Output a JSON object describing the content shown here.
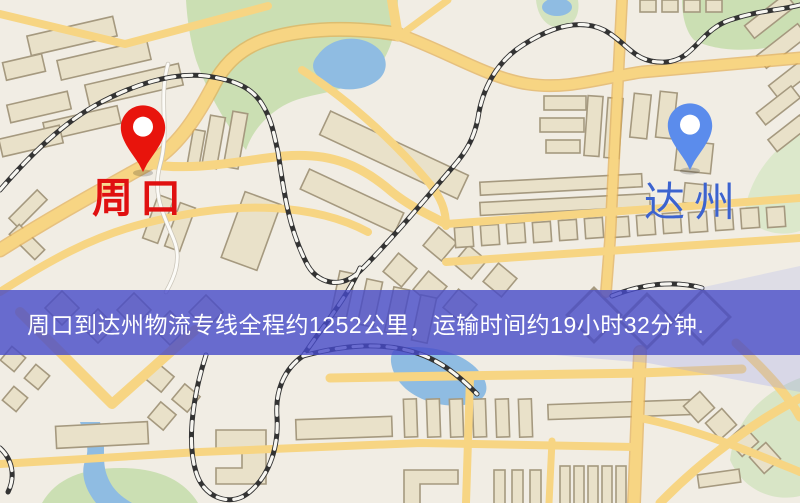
{
  "map": {
    "markers": {
      "origin": {
        "label": "周口",
        "pin_color": "#e8140c",
        "label_color": "#e01010",
        "pin_icon": "map-pin"
      },
      "destination": {
        "label": "达州",
        "pin_color": "#5b8cec",
        "label_color": "#3c63cf",
        "pin_icon": "map-pin"
      }
    },
    "colors": {
      "background": "#f1ede4",
      "road": "#f7d583",
      "road_casing": "#e2ae54",
      "building_fill": "#e9e1c9",
      "building_outline": "#a5997f",
      "park_green": "#cbdfb3",
      "water_blue": "#8fbce2",
      "railway_dark": "#333333"
    }
  },
  "banner": {
    "text": "周口到达州物流专线全程约1252公里，运输时间约19小时32分钟.",
    "background": "#464ac8",
    "text_color": "#ffffff",
    "route": {
      "origin": "周口",
      "destination": "达州",
      "service": "物流专线",
      "distance": "约1252公里",
      "duration": "约19小时32分钟"
    }
  }
}
